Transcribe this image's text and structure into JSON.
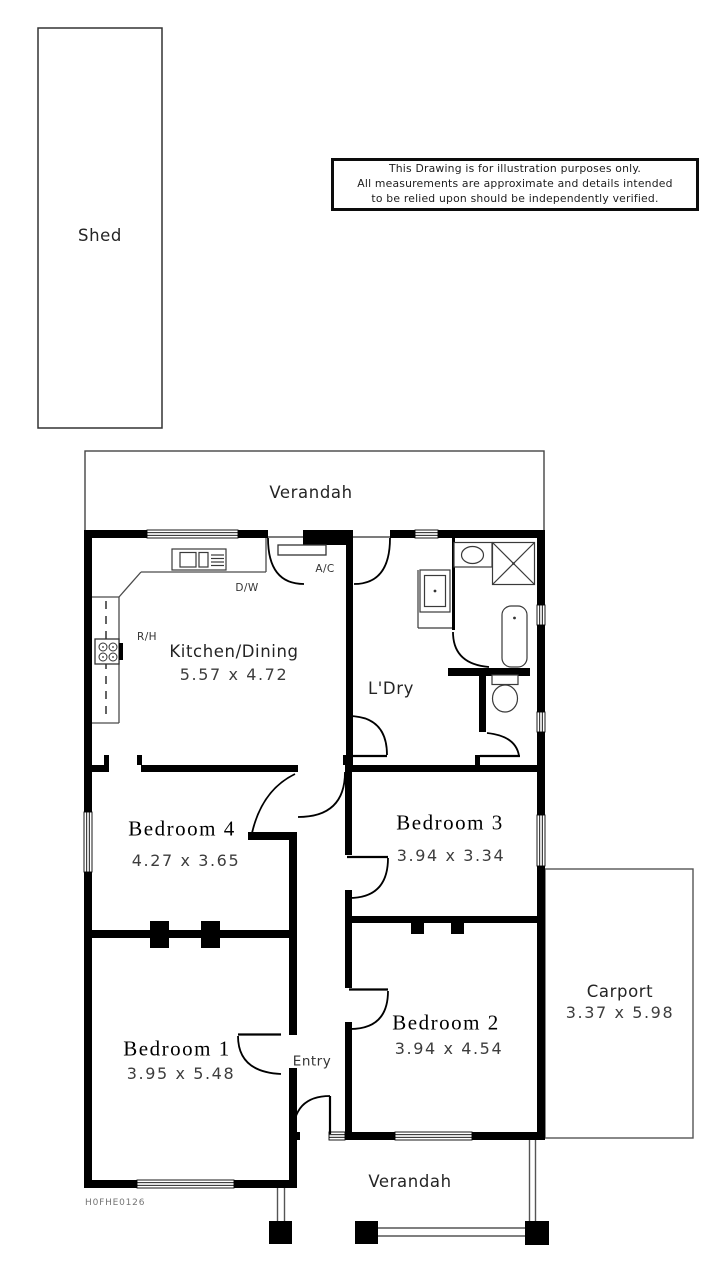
{
  "disclaimer": {
    "line1": "This Drawing is for illustration purposes only.",
    "line2": "All measurements are approximate and details intended",
    "line3": "to be relied upon should be independently verified."
  },
  "plan_code": "H0FHE0126",
  "outbuildings": {
    "shed": {
      "label": "Shed"
    },
    "carport": {
      "label": "Carport",
      "dimensions": "3.37 x 5.98"
    }
  },
  "verandah_rear": {
    "label": "Verandah"
  },
  "verandah_front": {
    "label": "Verandah"
  },
  "rooms": {
    "kitchen_dining": {
      "label": "Kitchen/Dining",
      "dimensions": "5.57 x 4.72"
    },
    "laundry": {
      "label": "L'Dry"
    },
    "bedroom1": {
      "label": "Bedroom 1",
      "dimensions": "3.95 x 5.48"
    },
    "bedroom2": {
      "label": "Bedroom 2",
      "dimensions": "3.94 x 4.54"
    },
    "bedroom3": {
      "label": "Bedroom 3",
      "dimensions": "3.94 x 3.34"
    },
    "bedroom4": {
      "label": "Bedroom 4",
      "dimensions": "4.27 x 3.65"
    },
    "entry": {
      "label": "Entry"
    }
  },
  "annotations": {
    "air_conditioner": "A/C",
    "dishwasher": "D/W",
    "range_hood": "R/H"
  },
  "colors": {
    "wall": "#000000",
    "thin_line": "#4a4a4a",
    "dimension_text": "#3d3d3d",
    "background": "#ffffff"
  }
}
